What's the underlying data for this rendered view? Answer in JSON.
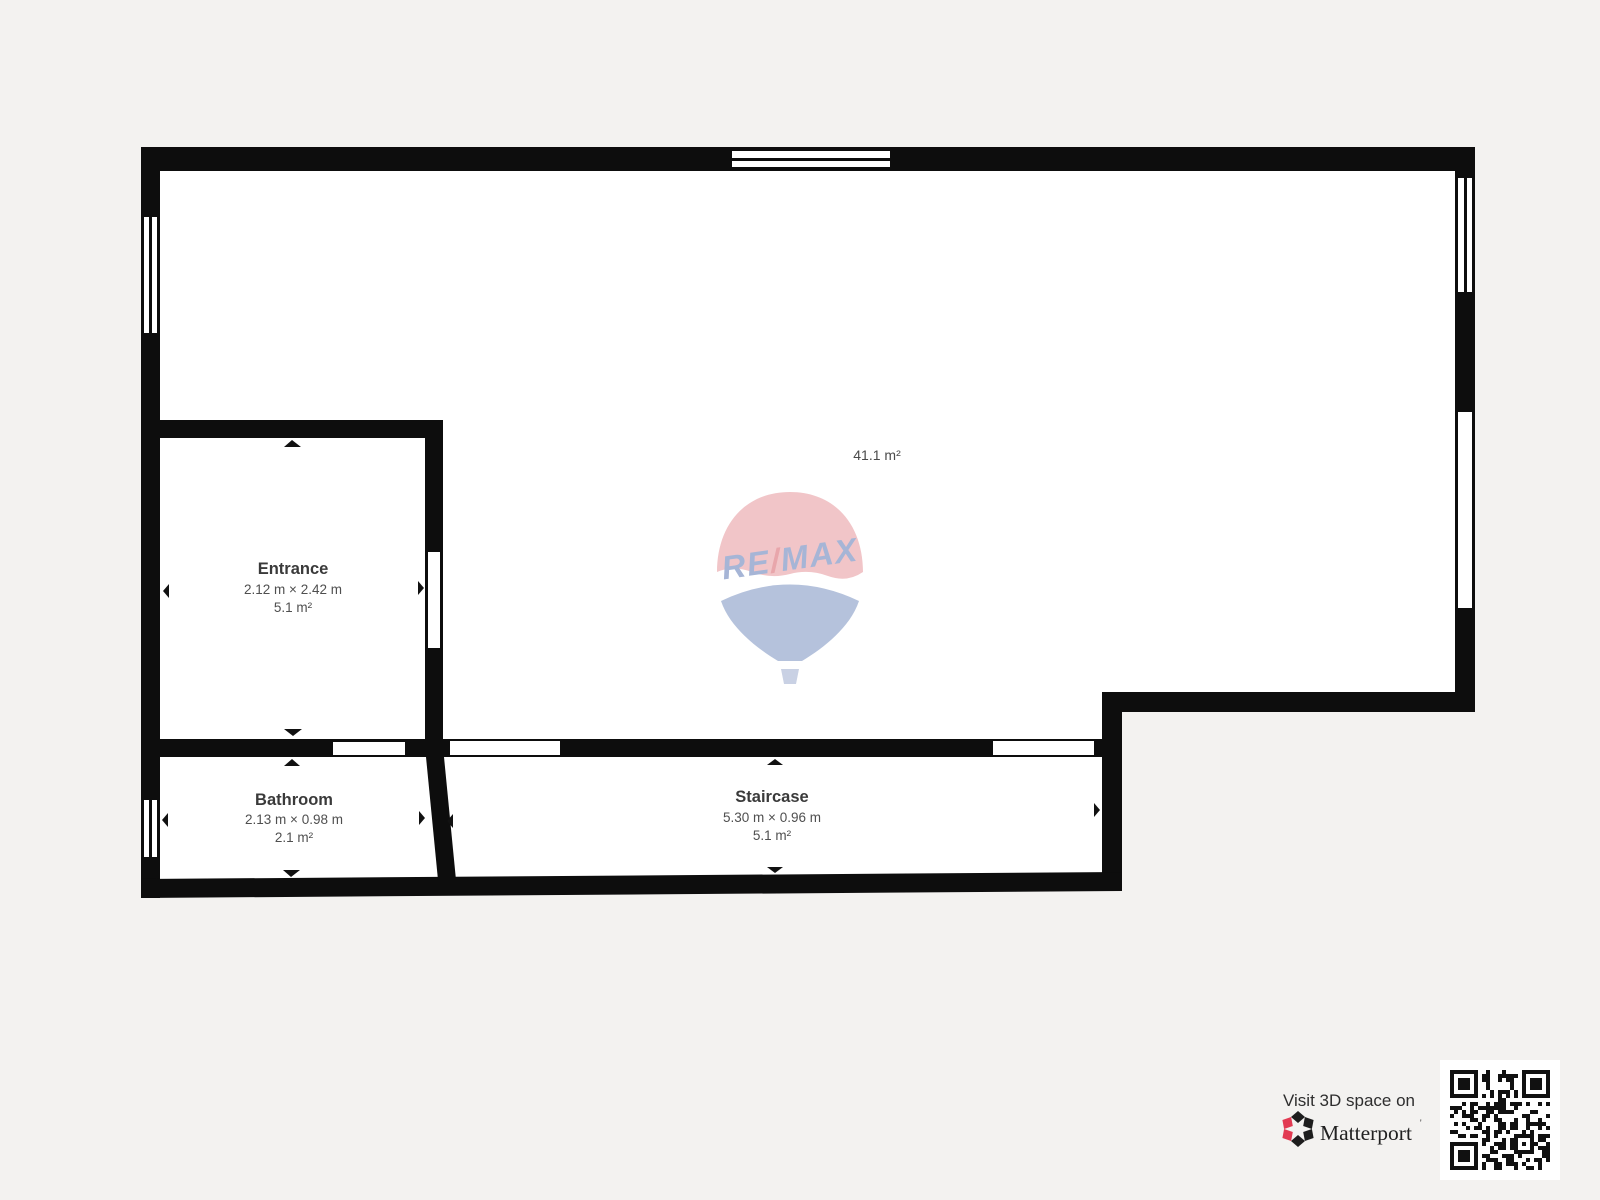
{
  "colors": {
    "background": "#f3f2f0",
    "wall": "#0d0d0d",
    "floor": "#ffffff",
    "room_title_text": "#3a3a3a",
    "room_secondary_text": "#4f4f4f",
    "balloon_pink": "#f1c5c8",
    "balloon_blue": "#b5c2dc",
    "balloon_text_blue": "#a6b5d6",
    "balloon_slash_red": "#e8a6ab",
    "matterport_red": "#e23a52",
    "matterport_black": "#1d1d1d"
  },
  "plan": {
    "main_room": {
      "area": "41.1 m²"
    },
    "rooms": [
      {
        "name": "Entrance",
        "dimensions": "2.12 m × 2.42 m",
        "area": "5.1 m²"
      },
      {
        "name": "Bathroom",
        "dimensions": "2.13 m × 0.98 m",
        "area": "2.1 m²"
      },
      {
        "name": "Staircase",
        "dimensions": "5.30 m × 0.96 m",
        "area": "5.1 m²"
      }
    ]
  },
  "watermark": {
    "re": "RE",
    "slash": "/",
    "max": "MAX"
  },
  "footer": {
    "visit_text": "Visit 3D space on",
    "brand": "Matterport",
    "trademark": "'"
  }
}
